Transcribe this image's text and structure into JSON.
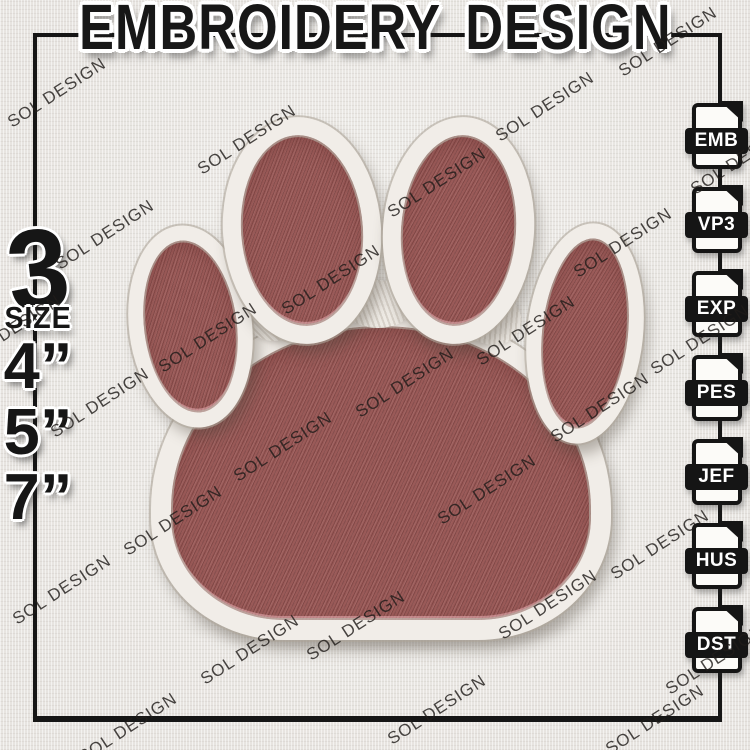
{
  "title": "EMBROIDERY DESIGN",
  "watermark_text": "SOL DESIGN",
  "size_panel": {
    "count": "3",
    "label": "SIZE",
    "sizes": [
      "4”",
      "5”",
      "7”"
    ]
  },
  "file_formats": [
    "EMB",
    "VP3",
    "EXP",
    "PES",
    "JEF",
    "HUS",
    "DST"
  ],
  "artwork": {
    "subject": "paw print embroidery patch",
    "colors": {
      "pad_fill": "#9a5a58",
      "stitch_border": "#f1ede8",
      "background_fabric": "#e9e7e3",
      "ink": "#161616"
    }
  }
}
